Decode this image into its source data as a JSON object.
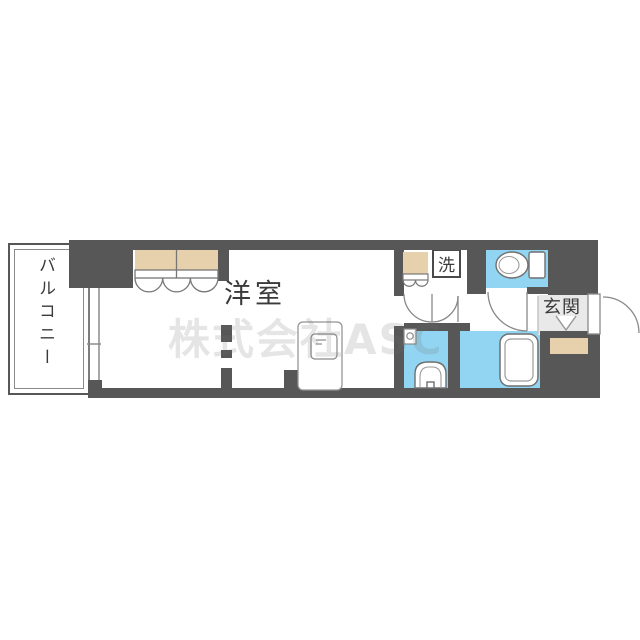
{
  "labels": {
    "balcony": "バルコニー",
    "western_room": "洋室",
    "entrance": "玄関",
    "washer": "洗"
  },
  "watermark": "株式会社ASC",
  "theme": {
    "wall": "#575757",
    "wet": "#92d5f2",
    "closet": "#e7d1ad",
    "genkan": "#e9e9e9",
    "text": "#3a3a3a",
    "wm": "#6e6e6e2e"
  },
  "icons": [
    "toilet-icon",
    "bathtub-icon",
    "washbasin-icon",
    "kitchen-counter-icon",
    "stove-icon",
    "window-icon",
    "entrance-door-icon",
    "door-arc-icon",
    "closet-folding-door-icon",
    "step-arrow-icon"
  ]
}
